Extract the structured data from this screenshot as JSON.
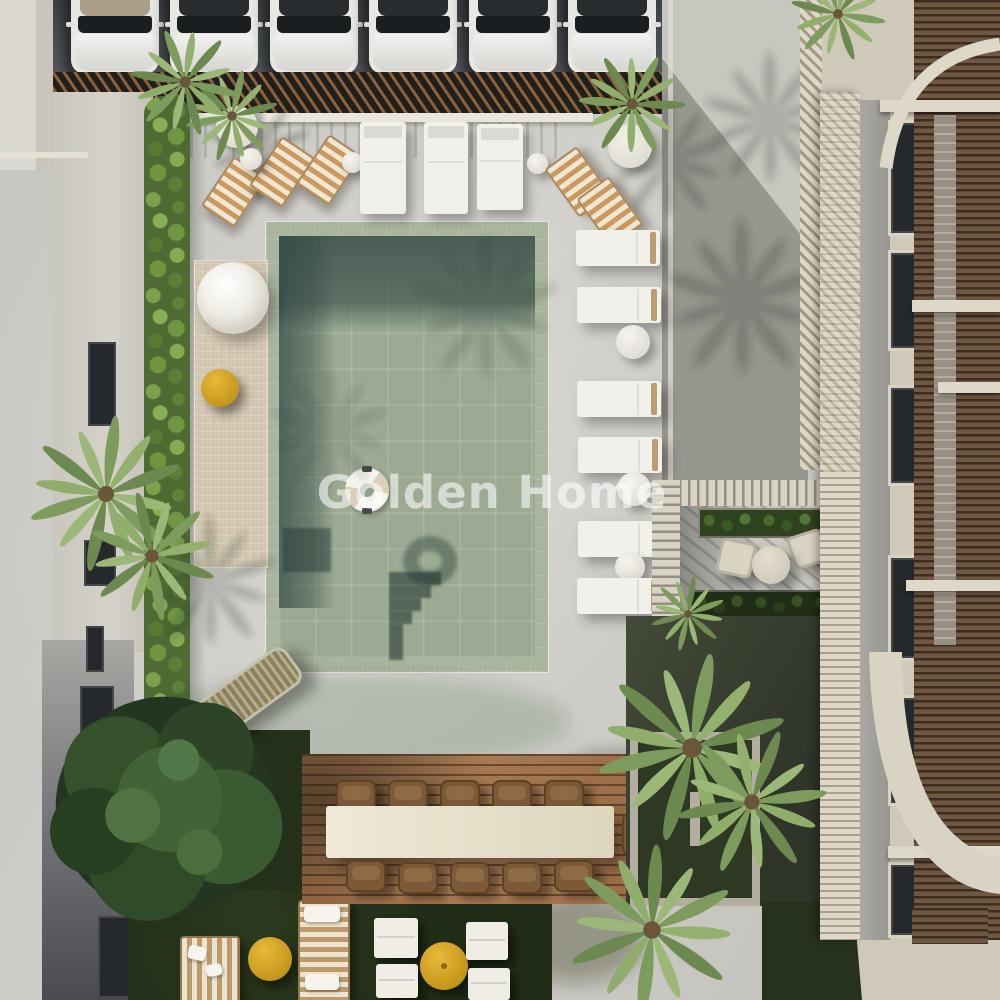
{
  "meta": {
    "image_type": "3D architectural rendering, aerial top-down view",
    "subject": "Residential courtyard with swimming pool, sun decks, parking row and apartment buildings"
  },
  "watermark": {
    "text": "Golden Home",
    "color": "#ffffff",
    "opacity": 0.58
  },
  "palette": {
    "concrete": "#cbcac4",
    "asphalt": "#474c50",
    "pool_tile_light": "#9caa94",
    "pool_tile_shadow": "#5f7872",
    "pool_coping": "#a9b59d",
    "terracotta_roof": "#c97c57",
    "wood_deck": "#9a6c47",
    "wood_louver": "#6f5742",
    "cream_trim": "#ded8c8",
    "lawn": "#222d18",
    "hedge_green": "#6d9440",
    "accent_yellow": "#d8a725",
    "furniture_white": "#f1f0ea",
    "stripe_tan": "#bd9a6d"
  },
  "scene": {
    "parking": {
      "cars_white": 5,
      "cars_convertible": 1,
      "pergola": "dark slatted carport canopy"
    },
    "pool": {
      "shape": "rectangular",
      "float_rings": 1,
      "steps": "corner stairs with cast shadow",
      "submerged_bench": 1
    },
    "sun_furniture": {
      "poolside_white_loungers": 6,
      "top_white_loungers": 3,
      "striped_deck_chairs": 5,
      "round_side_tables": 7,
      "round_daybed_white": 1,
      "yellow_poufs_tables": 3,
      "yellow_parasol": 1,
      "hammock": 1,
      "striped_daybeds_lawn": 2,
      "lawn_white_loungers": 4
    },
    "dining": {
      "long_table": 1,
      "wicker_chairs": 11,
      "surface": "wooden deck"
    },
    "pergola_lounge": {
      "chairs": 2,
      "round_table": 1,
      "planter_boxes": 2,
      "cover": "white slatted pergola"
    },
    "vegetation": {
      "fan_palms": 9,
      "round_tree": 1,
      "hedge_strip": 1,
      "lawn_patches": 2
    },
    "buildings": {
      "left": "terracotta tiled roof house with grey wall and windows",
      "right": "apartment facade with brown wood louvers, cream beams, arches and white balcony railings",
      "top": "carport / parking deck"
    }
  }
}
